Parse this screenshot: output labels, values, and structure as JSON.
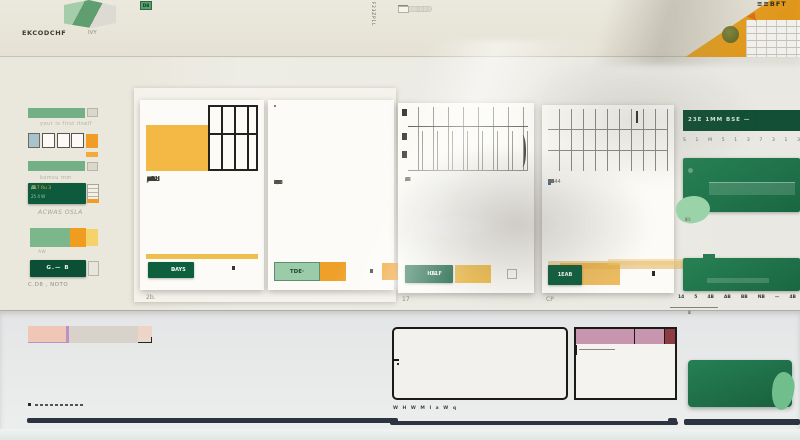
{
  "palette": {
    "bg_top": "#e9e7dd",
    "bg_mid": "#edece5",
    "bg_bottom": "#e7e8e9",
    "card": "#fcfbf7",
    "excel_green_dark": "#0d5a3c",
    "excel_green": "#1e7a50",
    "green_mid": "#74b085",
    "green_light": "#9bd3a9",
    "orange": "#ef9d26",
    "amber": "#efbf4f",
    "navy": "#2b3440",
    "orange_header": "#ee7d1f",
    "pink_header": "#c795ad",
    "maroon": "#8e3b43",
    "hdr": "#ead8ca",
    "hd2": "#e0ddd0",
    "sal": "#ecd4c6",
    "gry": "#d8d2cb",
    "grn": "#6cab7c",
    "pnk": "#eec7b6",
    "ost": "#dc9a4a",
    "odk": "#c9842f",
    "pur": "#ba92c5",
    "pal": "#e9e4d4",
    "brn": "#aa6424",
    "yl1": "#eac25a",
    "yl2": "#f1d483",
    "tan": "#dcb98b",
    "dot": "#e3c63f"
  },
  "header": {
    "logo_text": "EKCODCHF",
    "logo_sub": "IVY",
    "vertical_label": "F23ZP1L",
    "corner_text": "≡≡BFT",
    "chip_rows": [
      {
        "style": "orange",
        "values": [
          "18",
          "B6",
          "F4",
          "D6",
          "N8",
          "D3",
          "O3"
        ]
      },
      {
        "style": "gray",
        "values": [
          "08",
          "L3",
          "98",
          "09",
          "3b",
          "5W",
          "92"
        ]
      },
      {
        "style": "green",
        "values": [
          "23",
          "R8",
          "B8",
          "E8",
          "F8",
          "6J",
          "D8"
        ]
      }
    ],
    "ribbon_rows": [
      [
        "i",
        "b34",
        "g4",
        "c",
        "c",
        "c",
        "g6",
        "b20",
        "O",
        "g4",
        "t",
        "D",
        "g6",
        "c",
        "b16",
        "q",
        "c",
        "g4",
        "b24",
        "g4",
        "O",
        "t",
        "D"
      ],
      [
        "i",
        "b30",
        "g4",
        "c",
        "c",
        "q",
        "g6",
        "O",
        "b18",
        "G",
        "q",
        "g4",
        "b20",
        "K",
        "D",
        "g6",
        "c",
        "q",
        "b16",
        "g4",
        "O",
        "t",
        "D"
      ],
      [
        "i",
        "b26",
        "g6",
        "c",
        "G",
        "q",
        "g4",
        "b22",
        "O",
        "g4",
        "K",
        "D",
        "g6",
        "G",
        "b14",
        "q",
        "g4",
        "b20",
        "g4",
        "O",
        "t",
        "W"
      ]
    ],
    "end_chips": [
      "D",
      "K",
      "D"
    ]
  },
  "sidebar": {
    "w1_caption": "your is first itself",
    "w3_caption": "komsu mm",
    "panel_line1": "117 Ru 3",
    "panel_line1b": " /B",
    "panel_line2": "25 4 W",
    "panel_caption": "ACWAS OSLA",
    "stack_caption": "AW",
    "button_label": "G.— B",
    "button_caption": "C.D8 , NOTO"
  },
  "cards": [
    {
      "button_label": "DAYS",
      "button_sub": "≡",
      "caption": "2b.",
      "artwork": "orange-columns",
      "art_colors": [
        "#bd8d2f",
        "#f7f2e6",
        "#e8930e",
        "#fdfcf9",
        "#c8801b",
        "#f6e8c6",
        "#e99b14",
        "#fbf6ec",
        "#f0a921"
      ],
      "cal": {
        "bold_rows": [
          0,
          1,
          2,
          3,
          4,
          5,
          6
        ],
        "rows": [
          [
            "J8",
            "13",
            "2",
            "2",
            "X",
            "3",
            "3",
            "2i"
          ],
          [
            "1Cd",
            "9.2",
            "22",
            "2",
            "–",
            "3",
            "4",
            "4"
          ],
          [
            "12b",
            "C3",
            "4",
            "–",
            "A",
            "4",
            "4",
            "4"
          ],
          [
            "13d",
            "9b",
            "–",
            "a",
            "a",
            "O",
            "4",
            "4"
          ],
          [
            "1f2",
            "c5",
            "ab",
            "O",
            "O",
            "3",
            "7",
            "1"
          ],
          [
            "–2",
            "A",
            "O",
            "2",
            "O",
            "3",
            "V",
            "·"
          ],
          [
            "–",
            "4",
            "1",
            "O",
            "4",
            "5",
            "O",
            "4"
          ]
        ]
      }
    },
    {
      "button_label": "TDE·",
      "artwork": "glass-stripes",
      "art_colors": [
        [
          "#e08a10",
          "#d98a12"
        ],
        [
          "#f0a52e",
          "#f7f3ea"
        ],
        [
          "#fdfcfa",
          "#ef9c1b"
        ],
        [
          "#e8930f",
          "#f5efe2"
        ],
        [
          "#f3ab30",
          "#fdfcf8"
        ],
        [
          "#fbf9f4",
          "#e8940f"
        ],
        [
          "#f0a02a",
          "#f6dfb0"
        ],
        [
          "#fdfcfa",
          "#a5d3e2"
        ],
        [
          "#ef9c1e",
          "#fdf9f2"
        ],
        [
          "#f6c96a",
          "#e8930f"
        ]
      ],
      "cal": {
        "bold_rows": [
          0
        ],
        "bar_after": 3,
        "rows": [
          [
            "2",
            "15",
            "1",
            "5.8",
            "5K",
            "5",
            "X",
            "B",
            "X",
            "3"
          ],
          [
            "1d",
            "1d",
            "3e",
            "3",
            "1/7",
            "2e",
            "3",
            "O",
            "2",
            "4"
          ],
          [
            "5D",
            "D",
            "–",
            "1d",
            "A",
            "5",
            "3",
            "4",
            "3",
            "4"
          ],
          [
            "1d",
            "2",
            "·",
            "4",
            "2",
            "5",
            "3",
            "4",
            "3",
            "4"
          ],
          [
            "a",
            "m",
            "s",
            "·",
            "–",
            "·",
            "–",
            "·",
            "",
            ""
          ],
          [
            "4",
            "4b",
            "4",
            "·",
            "O",
            "3",
            "·",
            "2",
            "",
            ""
          ],
          [
            "1d",
            "4",
            "4",
            "–",
            "O",
            "–",
            "O",
            "·",
            "",
            ""
          ]
        ]
      }
    },
    {
      "button_label": "HALF",
      "button_sub": "12",
      "caption": "17",
      "artwork": "grid-a",
      "cal": {
        "bold_rows": [
          0
        ],
        "rows": [
          [
            "L",
            "I",
            "I",
            "E",
            "S",
            "1",
            "L",
            "I",
            "S",
            "–"
          ],
          [
            "·B",
            "N",
            "B",
            "N",
            "·B",
            "A",
            "A",
            "/",
            "B",
            "·"
          ],
          [
            "·N",
            "H",
            "N",
            "·N",
            "·B",
            "A",
            "A",
            "/",
            "B",
            "·"
          ],
          [
            "·M",
            "M",
            "B",
            "·B",
            "N",
            "B",
            "·",
            "A",
            "·",
            "·"
          ],
          [
            "·B",
            "B",
            "N",
            "·B",
            "·B",
            "·B",
            "·",
            "B",
            "·",
            "·"
          ],
          [
            "·B",
            "B",
            "N",
            "·B",
            "·B",
            "B",
            "·",
            "·",
            "·",
            "·"
          ],
          [
            "·O",
            "O",
            "B",
            "·B",
            "·B",
            "·B",
            "·",
            "·",
            "·",
            "·"
          ]
        ]
      }
    },
    {
      "button_label": "1EAB",
      "caption": "CP",
      "artwork": "grid-b",
      "cal": {
        "bold_rows": [
          0
        ],
        "hl": [
          0,
          0
        ],
        "rows": [
          [
            "1",
            "1",
            "2",
            "5",
            "2",
            "1",
            "1",
            "1",
            "5",
            "·"
          ],
          [
            "13",
            "B",
            "B",
            "2",
            "4",
            "B",
            "2",
            "B",
            "10",
            "13"
          ],
          [
            "13",
            "A",
            "B",
            "2",
            "2",
            "4",
            "2",
            "d",
            "H",
            "O"
          ],
          [
            "12",
            "3",
            "2",
            "O",
            "4",
            "2",
            "2",
            "24",
            "8",
            ""
          ],
          [
            "7B",
            "A",
            "B",
            "O",
            "2",
            "2",
            "2",
            "2",
            "11",
            "B"
          ],
          [
            "1B",
            "B",
            "3",
            "·",
            "1644",
            "",
            "",
            "",
            "",
            ""
          ]
        ]
      }
    }
  ],
  "right_panel": {
    "header_label": "23E  1MM  BSE —",
    "weekday_row": [
      "S",
      "1",
      "M",
      "5",
      "1",
      "3",
      "7",
      "3",
      "1",
      "3"
    ],
    "cal1": [
      [
        "10",
        "1",
        "2",
        "3",
        "2",
        "3",
        "2",
        "2",
        "1",
        "3"
      ],
      [
        "1",
        "2",
        "3",
        "1",
        "4",
        "1",
        "3",
        "4",
        "2",
        "1"
      ],
      [
        "21",
        "4",
        "3",
        "4",
        "3",
        "1",
        "2",
        "3",
        "4",
        "2"
      ],
      [
        "2",
        "1",
        "4",
        "2",
        "3",
        "4",
        "1",
        "2",
        "3",
        "4"
      ]
    ],
    "bold_row": [
      "14",
      "5",
      "4B",
      "AB",
      "BB",
      "NB",
      "—",
      "4B"
    ],
    "cal2": [
      [
        "1",
        "3",
        "2",
        "4",
        "1",
        "2",
        "3",
        "1",
        "4",
        "2"
      ],
      [
        "3",
        "1",
        "4",
        "2",
        "3",
        "1",
        "2",
        "4",
        "1",
        "3"
      ],
      [
        "2",
        "4",
        "1",
        "3",
        "2",
        "4",
        "1",
        "3",
        "2",
        "1"
      ]
    ]
  },
  "bottom": {
    "mosaic": {
      "heights": [
        17,
        11,
        17,
        16
      ],
      "gaps": [
        5,
        3,
        4,
        0
      ],
      "rows": [
        [
          {
            "w": 124,
            "c": "hdr",
            "bd": 1
          },
          {
            "sp": 4
          },
          {
            "w": 64,
            "c": "hdr",
            "bd": 1
          },
          {
            "sp": 8
          },
          {
            "w": 70,
            "c": "hd2",
            "bd": 1
          },
          {
            "sp": 2
          },
          {
            "w": 56,
            "c": "hd2",
            "bd": 1
          },
          {
            "sp": 4
          },
          {
            "w": 36,
            "c": "hd2"
          }
        ],
        [
          {
            "w": 124,
            "c": "sal"
          },
          {
            "sp": 4
          },
          {
            "w": 64,
            "c": "sal"
          },
          {
            "sp": 8
          },
          {
            "w": 70,
            "c": "sal"
          },
          {
            "sp": 2
          },
          {
            "w": 56,
            "c": "gry"
          },
          {
            "sp": 4
          },
          {
            "w": 36,
            "c": "gry"
          }
        ],
        [
          {
            "w": 27,
            "c": "grn"
          },
          {
            "sp": 3
          },
          {
            "w": 25,
            "c": "pnk"
          },
          {
            "sp": 4
          },
          {
            "w": 24,
            "c": "ost"
          },
          {
            "sp": 1
          },
          {
            "w": 19,
            "c": "odk"
          },
          {
            "sp": 3
          },
          {
            "w": 17,
            "c": "ost"
          },
          {
            "sp": 6
          },
          {
            "w": 110,
            "c": "gry"
          },
          {
            "sp": 2
          },
          {
            "w": 41,
            "c": "pur"
          },
          {
            "sp": 6
          },
          {
            "w": 7,
            "c": "dot"
          },
          {
            "sp": 4
          },
          {
            "w": 33,
            "c": "pur"
          }
        ],
        [
          {
            "w": 24,
            "c": "pal",
            "bd": 1
          },
          {
            "sp": 4
          },
          {
            "w": 38,
            "c": "pnk"
          },
          {
            "sp": 1
          },
          {
            "w": 24,
            "c": "pnk"
          },
          {
            "sp": 4
          },
          {
            "w": 17,
            "c": "ost"
          },
          {
            "sp": 5
          },
          {
            "w": 14,
            "c": "brn"
          },
          {
            "sp": 1
          },
          {
            "w": 17,
            "c": "yl1"
          },
          {
            "sp": 2
          },
          {
            "w": 18,
            "c": "yl2"
          },
          {
            "sp": 2
          },
          {
            "w": 26,
            "c": "tan"
          },
          {
            "sp": 6
          },
          {
            "w": 37,
            "c": "pnk"
          },
          {
            "sp": 12
          },
          {
            "w": 30,
            "c": "pnk"
          },
          {
            "sp": 2
          },
          {
            "w": 20,
            "c": "pnk"
          }
        ]
      ]
    },
    "orange_table": {
      "rows": [
        {
          "lines": [
            62,
            40
          ]
        },
        {
          "lines": [
            70,
            38
          ]
        },
        {
          "lines": [
            66,
            28
          ]
        }
      ],
      "caption": "W H W M I a  W q"
    },
    "pink_table": {
      "header_widths": [
        58,
        30,
        11
      ],
      "row_count": 5,
      "first_line_w": 36
    },
    "green_widget": {
      "col_count": 6
    }
  }
}
